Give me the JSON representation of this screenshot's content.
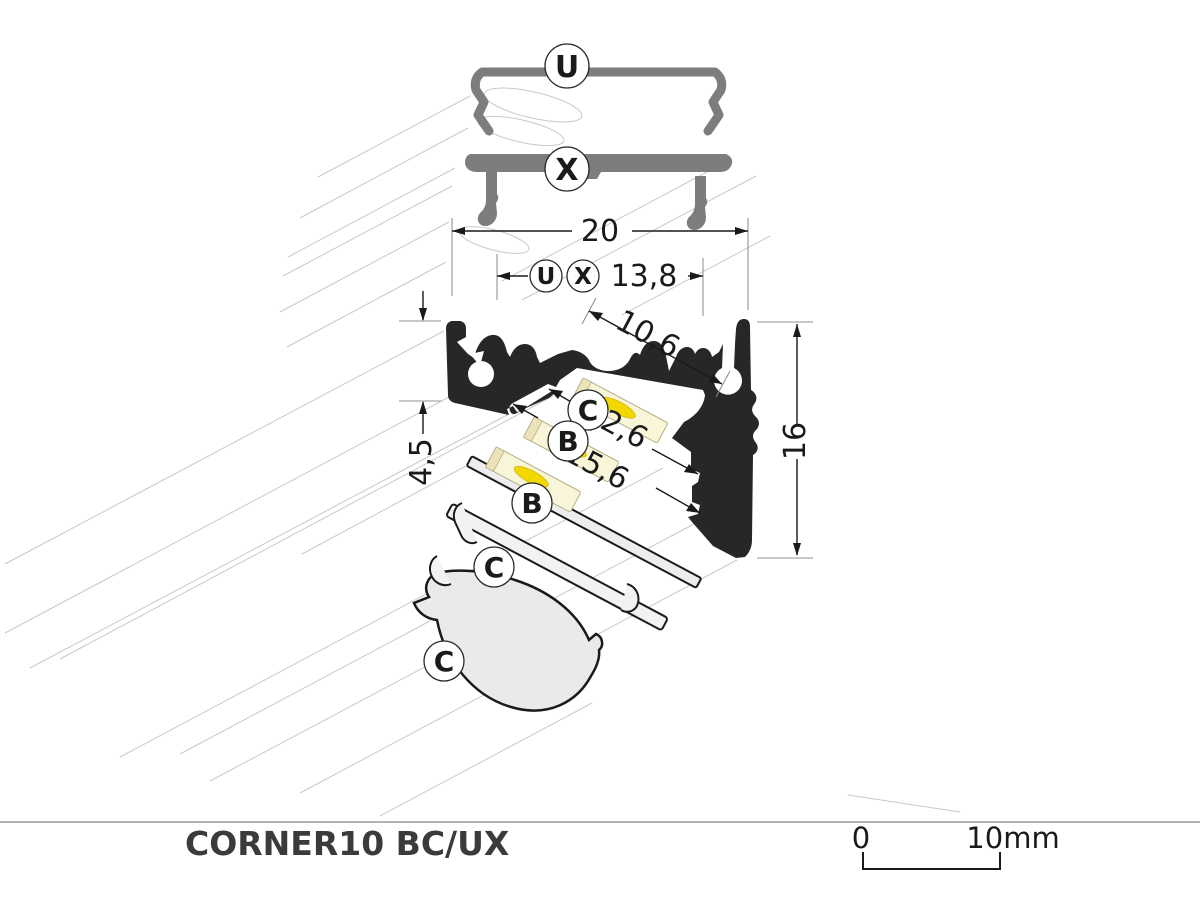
{
  "footer": {
    "title": "CORNER10 BC/UX",
    "scale_zero": "0",
    "scale_ten": "10mm"
  },
  "labels": {
    "cover_u": "U",
    "cover_x": "X",
    "cover_b": "B",
    "cover_c": "C"
  },
  "dimensions": {
    "overall_width": "20",
    "back_width": "13,8",
    "opening_width": "10,6",
    "groove_width_1": "12,6",
    "groove_width_2": "15,6",
    "flange_depth": "4,5",
    "height": "16"
  },
  "colors": {
    "profile_black": "#272727",
    "cover_gray": "#7d7d7d",
    "accent_teal": "#2aa18e",
    "accent_orange": "#e2573b",
    "led_yellow": "#f2d800",
    "strip_cream": "#f9f5d8",
    "cover_light": "#ededed",
    "guide_line": "#c9c9c9",
    "dimension": "#1a1a1a"
  }
}
